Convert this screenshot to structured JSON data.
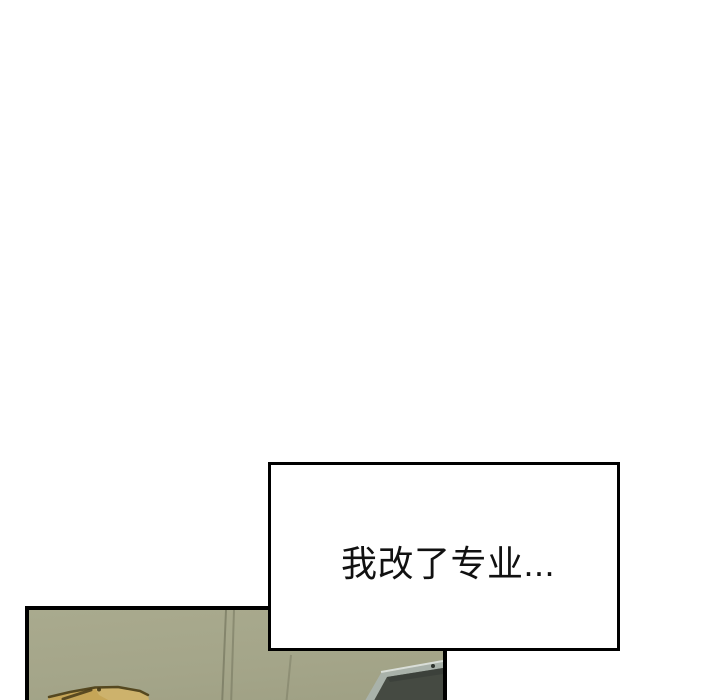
{
  "page": {
    "kind": "webtoon-comic-page",
    "background": "#ffffff"
  },
  "speech_box": {
    "text": "我改了专业...",
    "border_color": "#000000",
    "background": "#ffffff",
    "text_color": "#111111"
  },
  "panel": {
    "border_color": "#000000",
    "wall_color": "#a5a68a",
    "wall_line_color": "#70715a",
    "objects": {
      "cardboard_box": {
        "label": "cardboard-box-corner",
        "fill": "#c5a557",
        "edge": "#554820"
      },
      "laptop": {
        "label": "laptop-screen-back",
        "frame": "#a9b2aa",
        "screen": "#454a42",
        "highlight": "#d9ded8"
      }
    }
  },
  "theme": {
    "page-bg": "#ffffff",
    "panel-border": "#000000",
    "wall": "#a5a68a",
    "wall-line": "#70715a",
    "box-tan": "#c5a557",
    "box-edge": "#554820",
    "laptop-frame": "#a9b2aa",
    "laptop-screen": "#454a42",
    "laptop-highlight": "#d9ded8",
    "speech-border": "#000000",
    "speech-bg": "#ffffff",
    "speech-text": "#111111"
  }
}
